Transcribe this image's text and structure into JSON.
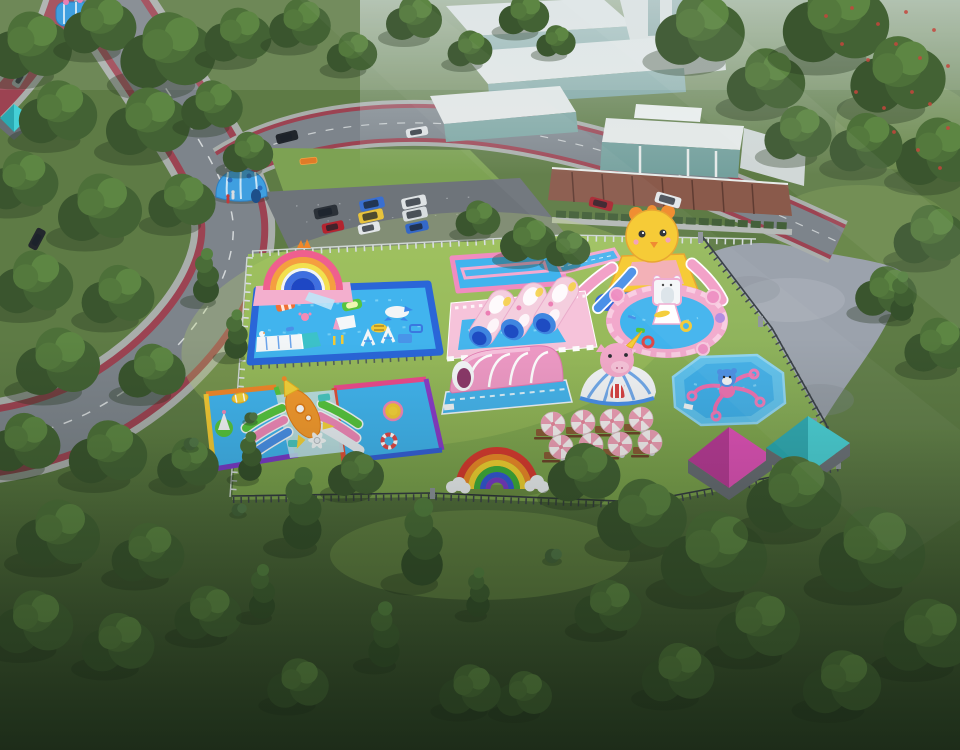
{
  "meta": {
    "width": 960,
    "height": 750,
    "description": "aerial 3d render of a pink-and-blue inflatable kids water park on a sunny lawn beside a road and modern white buildings"
  },
  "colors": {
    "grass_base": "#5e7b45",
    "grass_park_top": "#97bb5d",
    "grass_park_bottom": "#79a04c",
    "grass_lawn_top": "#5d7c42",
    "grass_lawn_bottom": "#2e4227",
    "road_asphalt": "#7d848b",
    "road_sidewalk": "#a9aeab",
    "bike_lane": "#9c4352",
    "road_line": "#e8ecec",
    "parking_asphalt": "#6e747a",
    "stone_path": "#9ba2ac",
    "fence_white": "#d8dde0",
    "fence_dark": "#3c434a",
    "pool_rim_blue": "#2a66d8",
    "pool_water": "#41b4ee",
    "rim_pink": "#f08cc0",
    "rainbow_red": "#d93a30",
    "rainbow_orange": "#ef8a28",
    "rainbow_yellow": "#f2d231",
    "rainbow_green": "#3fae3a",
    "rainbow_blue": "#3458d8",
    "rainbow_purple": "#7a3ac8",
    "inflatable_pink": "#f2a9cc",
    "inflatable_blue": "#4a90e8",
    "duck_yellow": "#f6c92f",
    "rocket_orange": "#f49a2e",
    "tent_magenta": "#e052b8",
    "tent_teal": "#45d0d6",
    "building_white": "#e3e7e6",
    "building_glass": "#76a19e",
    "building_base": "#8a5a4b",
    "tree_dark": "#36502c",
    "haze": "#d7e2e4"
  },
  "attractions": [
    {
      "id": "rainbow-arch-slide",
      "label": "rainbow arch slide with crown"
    },
    {
      "id": "main-frame-pool",
      "label": "large framed pool with floating obstacle course"
    },
    {
      "id": "slide-runout-pool",
      "label": "pink-rimmed slide run-out pool"
    },
    {
      "id": "chick-slide",
      "label": "yellow chick head double slide"
    },
    {
      "id": "castle-play-pool",
      "label": "pink castle round play pool"
    },
    {
      "id": "loaf-tunnel-bouncer",
      "label": "triple loaf tunnel bouncer on checkered base"
    },
    {
      "id": "arch-tunnel-bouncer",
      "label": "pink arched tunnel bouncer"
    },
    {
      "id": "unicorn-dome",
      "label": "unicorn head dome tent"
    },
    {
      "id": "spinner-pool",
      "label": "octagon pool with spinner seats"
    },
    {
      "id": "rocket-twin-pools",
      "label": "twin rainbow-rim pools with rocket slide"
    },
    {
      "id": "flat-rainbow",
      "label": "rainbow ground decoration with clouds"
    },
    {
      "id": "picnic-umbrellas",
      "label": "striped umbrellas with picnic tables"
    },
    {
      "id": "magenta-tent",
      "label": "magenta pyramid tent"
    },
    {
      "id": "teal-tent",
      "label": "teal pyramid tent"
    },
    {
      "id": "blue-dome",
      "label": "blue dome inflatable at roadside"
    },
    {
      "id": "blue-castle-corner",
      "label": "blue bouncy castle at top-left corner"
    },
    {
      "id": "parking-lot",
      "label": "parking lot with cars"
    },
    {
      "id": "modern-buildings",
      "label": "white terraced buildings with glass"
    },
    {
      "id": "stone-plaza",
      "label": "stone plaza path"
    }
  ],
  "trees": [
    [
      30,
      52,
      1.5,
      "r"
    ],
    [
      100,
      30,
      1.3,
      "r"
    ],
    [
      168,
      58,
      1.7,
      "r"
    ],
    [
      238,
      40,
      1.2,
      "r"
    ],
    [
      58,
      118,
      1.4,
      "r"
    ],
    [
      148,
      128,
      1.5,
      "r"
    ],
    [
      212,
      110,
      1.1,
      "r"
    ],
    [
      22,
      186,
      1.3,
      "r"
    ],
    [
      100,
      214,
      1.5,
      "r"
    ],
    [
      182,
      206,
      1.2,
      "r"
    ],
    [
      248,
      156,
      0.9,
      "r"
    ],
    [
      34,
      288,
      1.4,
      "r"
    ],
    [
      118,
      300,
      1.3,
      "r"
    ],
    [
      206,
      282,
      1.0,
      "t"
    ],
    [
      58,
      368,
      1.5,
      "r"
    ],
    [
      152,
      376,
      1.2,
      "r"
    ],
    [
      236,
      340,
      0.9,
      "t"
    ],
    [
      24,
      448,
      1.3,
      "r"
    ],
    [
      108,
      458,
      1.4,
      "r"
    ],
    [
      188,
      468,
      1.1,
      "r"
    ],
    [
      58,
      540,
      1.5,
      "r"
    ],
    [
      148,
      558,
      1.3,
      "r"
    ],
    [
      34,
      628,
      1.4,
      "r"
    ],
    [
      208,
      618,
      1.2,
      "r"
    ],
    [
      118,
      648,
      1.3,
      "r"
    ],
    [
      262,
      598,
      1.0,
      "t"
    ],
    [
      300,
      28,
      1.1,
      "r"
    ],
    [
      352,
      56,
      0.9,
      "r"
    ],
    [
      414,
      22,
      1.0,
      "r"
    ],
    [
      470,
      52,
      0.8,
      "r"
    ],
    [
      524,
      18,
      0.9,
      "r"
    ],
    [
      556,
      44,
      0.7,
      "r"
    ],
    [
      700,
      36,
      1.6,
      "r"
    ],
    [
      766,
      86,
      1.4,
      "r"
    ],
    [
      836,
      28,
      1.9,
      "r"
    ],
    [
      898,
      82,
      1.7,
      "r"
    ],
    [
      938,
      158,
      1.5,
      "r"
    ],
    [
      866,
      148,
      1.3,
      "r"
    ],
    [
      798,
      138,
      1.2,
      "r"
    ],
    [
      930,
      240,
      1.3,
      "r"
    ],
    [
      886,
      296,
      1.1,
      "r"
    ],
    [
      938,
      350,
      1.2,
      "r"
    ],
    [
      902,
      302,
      0.9,
      "t"
    ],
    [
      478,
      222,
      0.8,
      "r"
    ],
    [
      528,
      244,
      1.0,
      "r"
    ],
    [
      568,
      252,
      0.8,
      "r"
    ],
    [
      250,
      418,
      0.7,
      "b"
    ],
    [
      190,
      444,
      0.8,
      "b"
    ],
    [
      250,
      462,
      0.9,
      "t"
    ],
    [
      302,
      518,
      1.5,
      "t"
    ],
    [
      356,
      478,
      1.0,
      "r"
    ],
    [
      238,
      510,
      0.8,
      "b"
    ],
    [
      422,
      552,
      1.6,
      "t"
    ],
    [
      384,
      642,
      1.2,
      "t"
    ],
    [
      298,
      688,
      1.1,
      "r"
    ],
    [
      478,
      598,
      0.9,
      "t"
    ],
    [
      524,
      698,
      1.0,
      "r"
    ],
    [
      584,
      478,
      1.3,
      "r"
    ],
    [
      642,
      522,
      1.6,
      "r"
    ],
    [
      714,
      562,
      1.9,
      "r"
    ],
    [
      794,
      502,
      1.7,
      "r"
    ],
    [
      758,
      632,
      1.5,
      "r"
    ],
    [
      872,
      558,
      1.9,
      "r"
    ],
    [
      928,
      642,
      1.6,
      "r"
    ],
    [
      842,
      688,
      1.4,
      "r"
    ],
    [
      678,
      678,
      1.3,
      "r"
    ],
    [
      608,
      612,
      1.2,
      "r"
    ],
    [
      552,
      556,
      0.9,
      "b"
    ],
    [
      470,
      694,
      1.1,
      "r"
    ]
  ],
  "cars": [
    [
      326,
      212,
      -12,
      24,
      11,
      "#2b3138"
    ],
    [
      333,
      227,
      -12,
      22,
      10,
      "#b3242f"
    ],
    [
      372,
      204,
      -12,
      25,
      11,
      "#3a6fd0"
    ],
    [
      371,
      216,
      -12,
      25,
      11,
      "#e8c33c"
    ],
    [
      369,
      228,
      -12,
      22,
      10,
      "#e2e6e8"
    ],
    [
      414,
      202,
      -12,
      25,
      11,
      "#dfe3e5"
    ],
    [
      415,
      214,
      -12,
      25,
      11,
      "#d8dde0"
    ],
    [
      417,
      227,
      -12,
      23,
      10,
      "#3468c8"
    ],
    [
      287,
      137,
      -14,
      22,
      10,
      "#20252b"
    ],
    [
      417,
      132,
      -10,
      22,
      9,
      "#dfe3e6"
    ],
    [
      601,
      204,
      14,
      24,
      10,
      "#a82832"
    ],
    [
      668,
      200,
      16,
      26,
      11,
      "#e4e8ea"
    ],
    [
      95,
      189,
      -64,
      22,
      10,
      "#b5a488"
    ],
    [
      37,
      239,
      -62,
      22,
      10,
      "#23272d"
    ],
    [
      20,
      78,
      -58,
      20,
      9,
      "#9aa0a4"
    ]
  ],
  "umbrellas": [
    [
      553,
      424
    ],
    [
      583,
      422
    ],
    [
      612,
      421
    ],
    [
      641,
      419
    ],
    [
      561,
      447
    ],
    [
      591,
      445
    ],
    [
      620,
      444
    ],
    [
      650,
      442
    ]
  ],
  "people": [
    [
      48,
      92,
      "#c23a3a"
    ],
    [
      146,
      87,
      "#2a2e33"
    ],
    [
      233,
      196,
      "#d9dde0"
    ],
    [
      228,
      200,
      "#c23a3a"
    ],
    [
      58,
      272,
      "#23272c"
    ]
  ],
  "blossoms": [
    [
      826,
      16
    ],
    [
      852,
      8
    ],
    [
      878,
      24
    ],
    [
      906,
      12
    ],
    [
      934,
      30
    ],
    [
      948,
      66
    ],
    [
      920,
      58
    ],
    [
      896,
      44
    ],
    [
      868,
      60
    ],
    [
      842,
      44
    ],
    [
      930,
      104
    ],
    [
      948,
      128
    ],
    [
      912,
      92
    ],
    [
      884,
      108
    ],
    [
      856,
      92
    ],
    [
      940,
      168
    ],
    [
      918,
      150
    ],
    [
      894,
      132
    ]
  ]
}
